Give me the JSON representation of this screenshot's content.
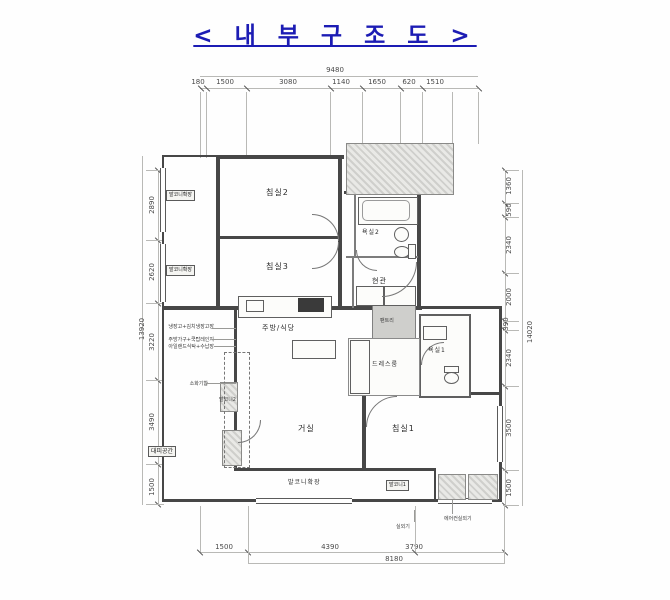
{
  "title": "< 내 부 구 조 도 >",
  "colors": {
    "title_blue": "#1c1cb4",
    "wall": "#474747",
    "hatch_gray": "#cfcfcc"
  },
  "dimensions": {
    "top": {
      "total": "9480",
      "segments": [
        "180",
        "1500",
        "3080",
        "1140",
        "1650",
        "620",
        "1510"
      ]
    },
    "left": {
      "total": "13920",
      "segments": [
        "2890",
        "2620",
        "3220",
        "3490",
        "1500"
      ]
    },
    "right": {
      "total": "14020",
      "segments": [
        "1360",
        "590",
        "2340",
        "2000",
        "390",
        "2340",
        "3500",
        "1500"
      ]
    },
    "bottom": {
      "total": "8180",
      "segments": [
        "1500",
        "4390",
        "3790"
      ]
    }
  },
  "rooms": {
    "bedroom2": "침실2",
    "bedroom3": "침실3",
    "bath2": "욕실2",
    "entrance": "현관",
    "kitchen": "주방/식당",
    "pantry": "팬트리",
    "dressroom": "드레스룸",
    "bath1": "욕실1",
    "living": "거실",
    "bedroom1": "침실1",
    "balcony2": "발코니2",
    "balcony_extension": "발코니확장",
    "balcony1": "발코니1",
    "refuge": "대피공간",
    "balcony_ext_left": "발코니확장"
  },
  "annotations": {
    "note1": "냉장고+김치냉장고장",
    "note2": "주방가구+쿡탑레인지",
    "note3": "아일랜드식탁+수납장",
    "note4": "소화기함",
    "outdoor_unit": "실외기",
    "ac_outdoor_unit": "에어컨실외기"
  }
}
